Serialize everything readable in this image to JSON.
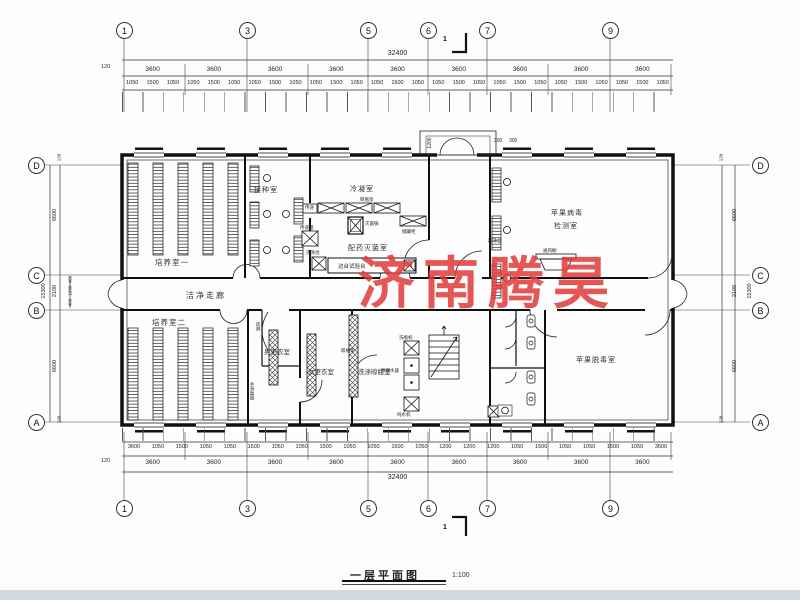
{
  "watermark": {
    "text": "济南腾昊",
    "color": "#e03838"
  },
  "title": {
    "text": "一层平面图",
    "scale": "1:100"
  },
  "axes": {
    "top": [
      "1",
      "3",
      "5",
      "6",
      "7",
      "9"
    ],
    "bottom": [
      "1",
      "3",
      "5",
      "6",
      "7",
      "9"
    ],
    "left": [
      "D",
      "C",
      "B",
      "A"
    ],
    "right": [
      "D",
      "C",
      "B",
      "A"
    ]
  },
  "dims": {
    "top_total": "32400",
    "bottom_total": "32400",
    "bays": [
      "3600",
      "3600",
      "3600",
      "3600",
      "3600",
      "3600",
      "3600",
      "3600",
      "3600"
    ],
    "top_small": [
      "1050",
      "1500",
      "1050",
      "1050",
      "1500",
      "1050",
      "1050",
      "1500",
      "1050",
      "1050",
      "1500",
      "1050",
      "1050",
      "1500",
      "1050",
      "1050",
      "1500",
      "1050",
      "1050",
      "1500",
      "1050",
      "1050",
      "1500",
      "1050",
      "1050",
      "1500",
      "1050"
    ],
    "bottom_small": [
      "3600",
      "1050",
      "1500",
      "1050",
      "1050",
      "1500",
      "1050",
      "1050",
      "1500",
      "1050",
      "1050",
      "1500",
      "1050",
      "1200",
      "1200",
      "1200",
      "1050",
      "1500",
      "1050",
      "1050",
      "1500",
      "1050",
      "3600"
    ],
    "edge": "120",
    "left_total": "15300",
    "right_total": "15300",
    "left_segs": [
      "6600",
      "2100",
      "6600"
    ],
    "right_segs": [
      "6600",
      "2100",
      "6600"
    ],
    "left_subs": [
      "450",
      "1200",
      "450"
    ],
    "entrance": {
      "depth": "1200",
      "a": "300",
      "b": "300"
    },
    "section": "1"
  },
  "rooms": {
    "r1": "培养室一",
    "r2": "接种室",
    "r3": "冷凝室",
    "r4": "配药灭菌室",
    "r5a": "苹果病毒",
    "r5b": "检测室",
    "corridor": "洁净走廊",
    "r6": "培养室二",
    "r7": "男更衣室",
    "r8": "女更衣室",
    "r9": "洗涤晾瓶室",
    "r10": "苹果脱毒室"
  },
  "equip": {
    "pass": "传递",
    "passbox": "传递箱",
    "rack_top": "晾瓶架",
    "sterilizer": "灭菌锅",
    "cabinet": "储藏柜",
    "bench": "边台试验台",
    "sink": "洗涤池",
    "cleanbench": "超净台",
    "fumehood": "通风橱",
    "airshower": "风淋",
    "bottlewasher": "洗瓶机",
    "distiller": "蒸馏水器",
    "purewater": "纯水机",
    "bottlerack": "晾瓶架",
    "handsan": "手消毒器"
  }
}
